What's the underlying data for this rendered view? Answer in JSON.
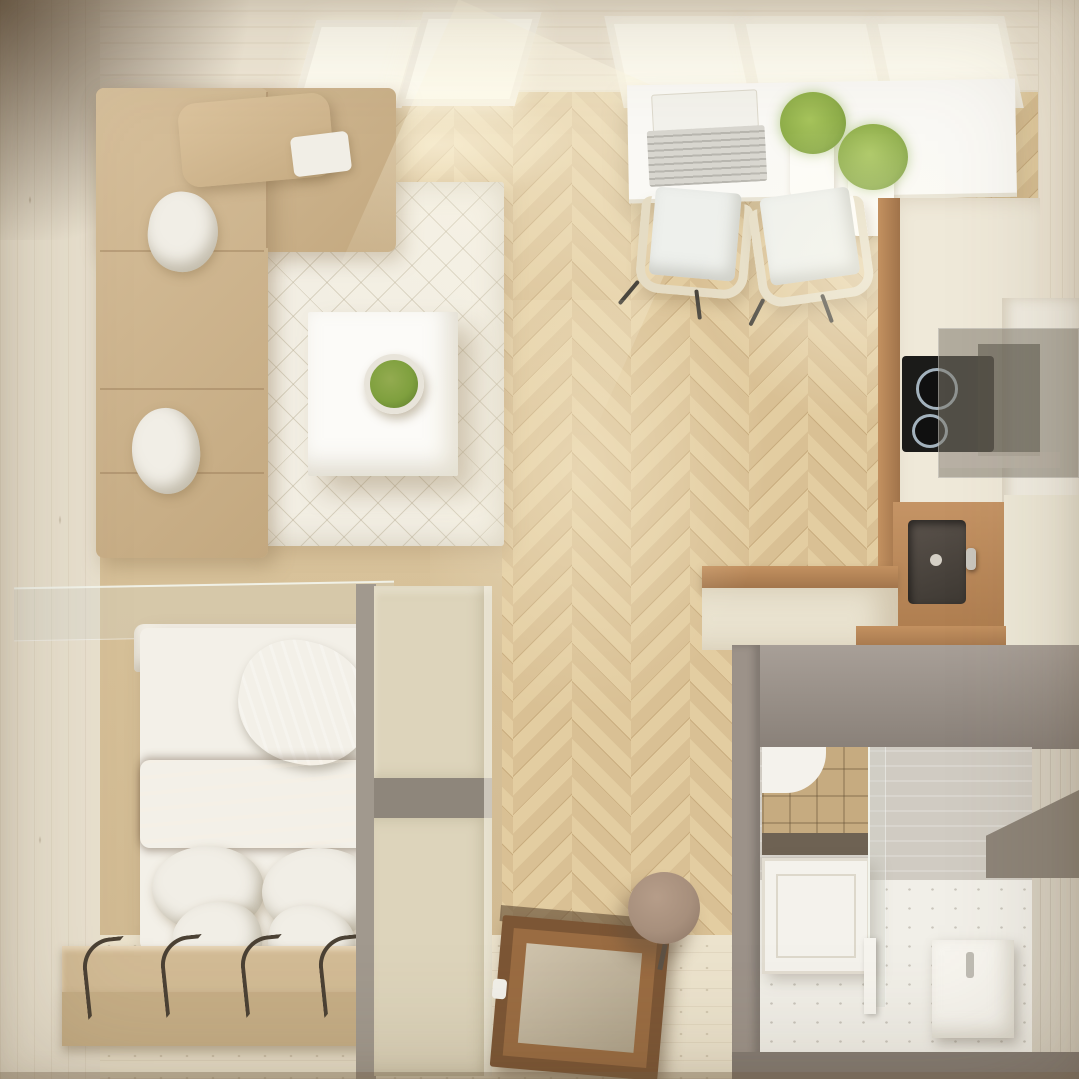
{
  "meta": {
    "description": "Top-down 3D interior render of a small studio apartment floor plan",
    "view": "overhead",
    "visible_text": null
  },
  "palette": {
    "wall": "#e9e1cf",
    "wall-top": "#efe7d6",
    "bath-right": "#d8d1c2",
    "window-bright": "#fffdf2",
    "window-frame": "#f6f2e6",
    "light-warm": "rgba(255,248,225,0.55)",
    "floor-a": "#e3cda1",
    "floor-b": "#d9c094",
    "floor-line": "#c9ad7f",
    "bedroom-floor": "#d8c29a",
    "hall-floor": "#ece3cd",
    "rug": "#f2eee3",
    "rug-line": "rgba(185,175,150,0.45)",
    "sofa": "#d7c09c",
    "sofa-dark": "#c3a87f",
    "pillow-white": "#f1eee6",
    "table-white": "#fcfbf8",
    "plant-green": "#7fa03e",
    "plant-tall": "#8fae4a",
    "plant-rim": "#e8e4da",
    "desk-white": "#faf9f5",
    "laptop-gray": "#d8d6cf",
    "chair-shell": "#e5dcc4",
    "chair-seat": "#eef0ec",
    "chair-leg": "#4a463e",
    "counter-cream": "#efe9d9",
    "counter-wood": "#c39160",
    "counter-wood-dark": "#a0734a",
    "cooktop-black": "#1b1b19",
    "burner-ring": "#a3b2bd",
    "hood-gray": "rgba(128,122,110,0.55)",
    "hood-inner": "rgba(88,83,73,0.55)",
    "sink-wood": "#c59465",
    "sink-basin": "#5a524b",
    "sink-basin-dark": "#3e3933",
    "taupe": "#9c9289",
    "taupe-dark": "#857c74",
    "bath-wall": "#d0cbc2",
    "bath-floor": "#f1efe8",
    "bath-tile": "#c6ab80",
    "tub-white": "#f4f2ec",
    "glass": "rgba(210,215,205,0.32)",
    "glass-edge": "rgba(246,249,241,0.85)",
    "shelf-dark": "#8d8478",
    "bed-sheet": "#f3f0e8",
    "headboard": "#f6f3ea",
    "bed-green": "#b4bfa2",
    "blanket": "#8d6c4f",
    "blanket-dark": "#6f5138",
    "step-tan": "#d2bb95",
    "step-tan2": "#c6ae86",
    "hook": "#4b4134",
    "wardrobe-cream": "#ddd4bb",
    "wardrobe-gray": "#a1998e",
    "wardrobe-recess": "#8e867b",
    "door-frame": "#7c5635",
    "door-frame2": "#9a6c42",
    "door-panel": "#cfc3ac",
    "door-handle": "#f2f0ea",
    "stool": "#a78f7c",
    "stool-dark": "#8a7463"
  },
  "scene": {
    "living_area": {
      "objects": [
        "corner-sofa",
        "white-throw-pillows",
        "bolster-cushion",
        "quilted-area-rug",
        "square-coffee-table",
        "moss-bowl-plant"
      ],
      "pillow_count": 2,
      "skylight_count": 2
    },
    "dining_workspace": {
      "objects": [
        "wall-desk",
        "open-laptop",
        "grass-pot-plants",
        "shell-chairs"
      ],
      "plant_count": 2,
      "chair_count": 2,
      "window_pane_count": 3
    },
    "kitchen": {
      "objects": [
        "counter-run",
        "induction-cooktop",
        "range-hood",
        "tall-cabinet",
        "inset-sink",
        "faucet",
        "peninsula-counter"
      ],
      "burner_count": 2
    },
    "bathroom": {
      "objects": [
        "tiled-shower",
        "bathtub-panel",
        "glass-screen",
        "washbasin-unit",
        "corner-shelf"
      ]
    },
    "bedroom": {
      "objects": [
        "double-bed",
        "headboard",
        "green-throw-pillow",
        "brown-blanket",
        "white-pillows",
        "platform-steps",
        "metal-hooks",
        "glass-shelf-partition",
        "wardrobe-unit"
      ],
      "white_pillow_count": 4,
      "hook_count": 5
    },
    "hallway": {
      "objects": [
        "entry-door-top-view",
        "round-stool",
        "herringbone-floor"
      ]
    }
  }
}
